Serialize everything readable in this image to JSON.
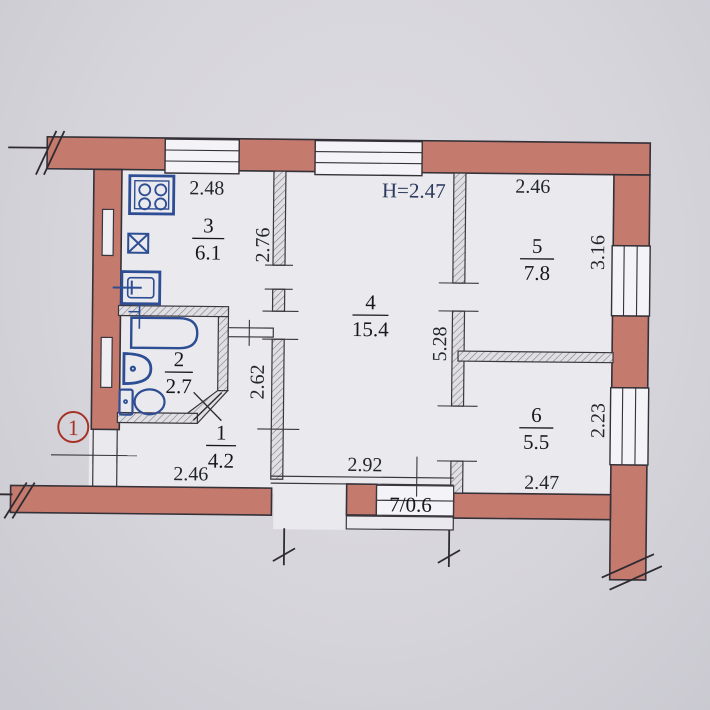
{
  "plan": {
    "height_label": "H=2.47",
    "marker_label": "1",
    "rooms": {
      "r1": {
        "number": "1",
        "area": "4.2"
      },
      "r2": {
        "number": "2",
        "area": "2.7"
      },
      "r3": {
        "number": "3",
        "area": "6.1"
      },
      "r4": {
        "number": "4",
        "area": "15.4"
      },
      "r5": {
        "number": "5",
        "area": "7.8"
      },
      "r6": {
        "number": "6",
        "area": "5.5"
      },
      "r7": {
        "label": "7/0.6"
      }
    },
    "dims": {
      "kitchen_width": "2.48",
      "room5_width": "2.46",
      "kitchen_depth": "2.76",
      "room5_depth": "3.16",
      "room4_depth": "5.28",
      "hall_depth": "2.62",
      "room6_depth": "2.23",
      "room4_width": "2.92",
      "hall_width": "2.46",
      "room6_width": "2.47"
    },
    "colors": {
      "wall": "#c57a6e",
      "fixtures": "#2d4e94",
      "marker": "#a83228",
      "dim_text": "#24262e",
      "height_text": "#2b3a5e",
      "room_text": "#17171c"
    }
  }
}
